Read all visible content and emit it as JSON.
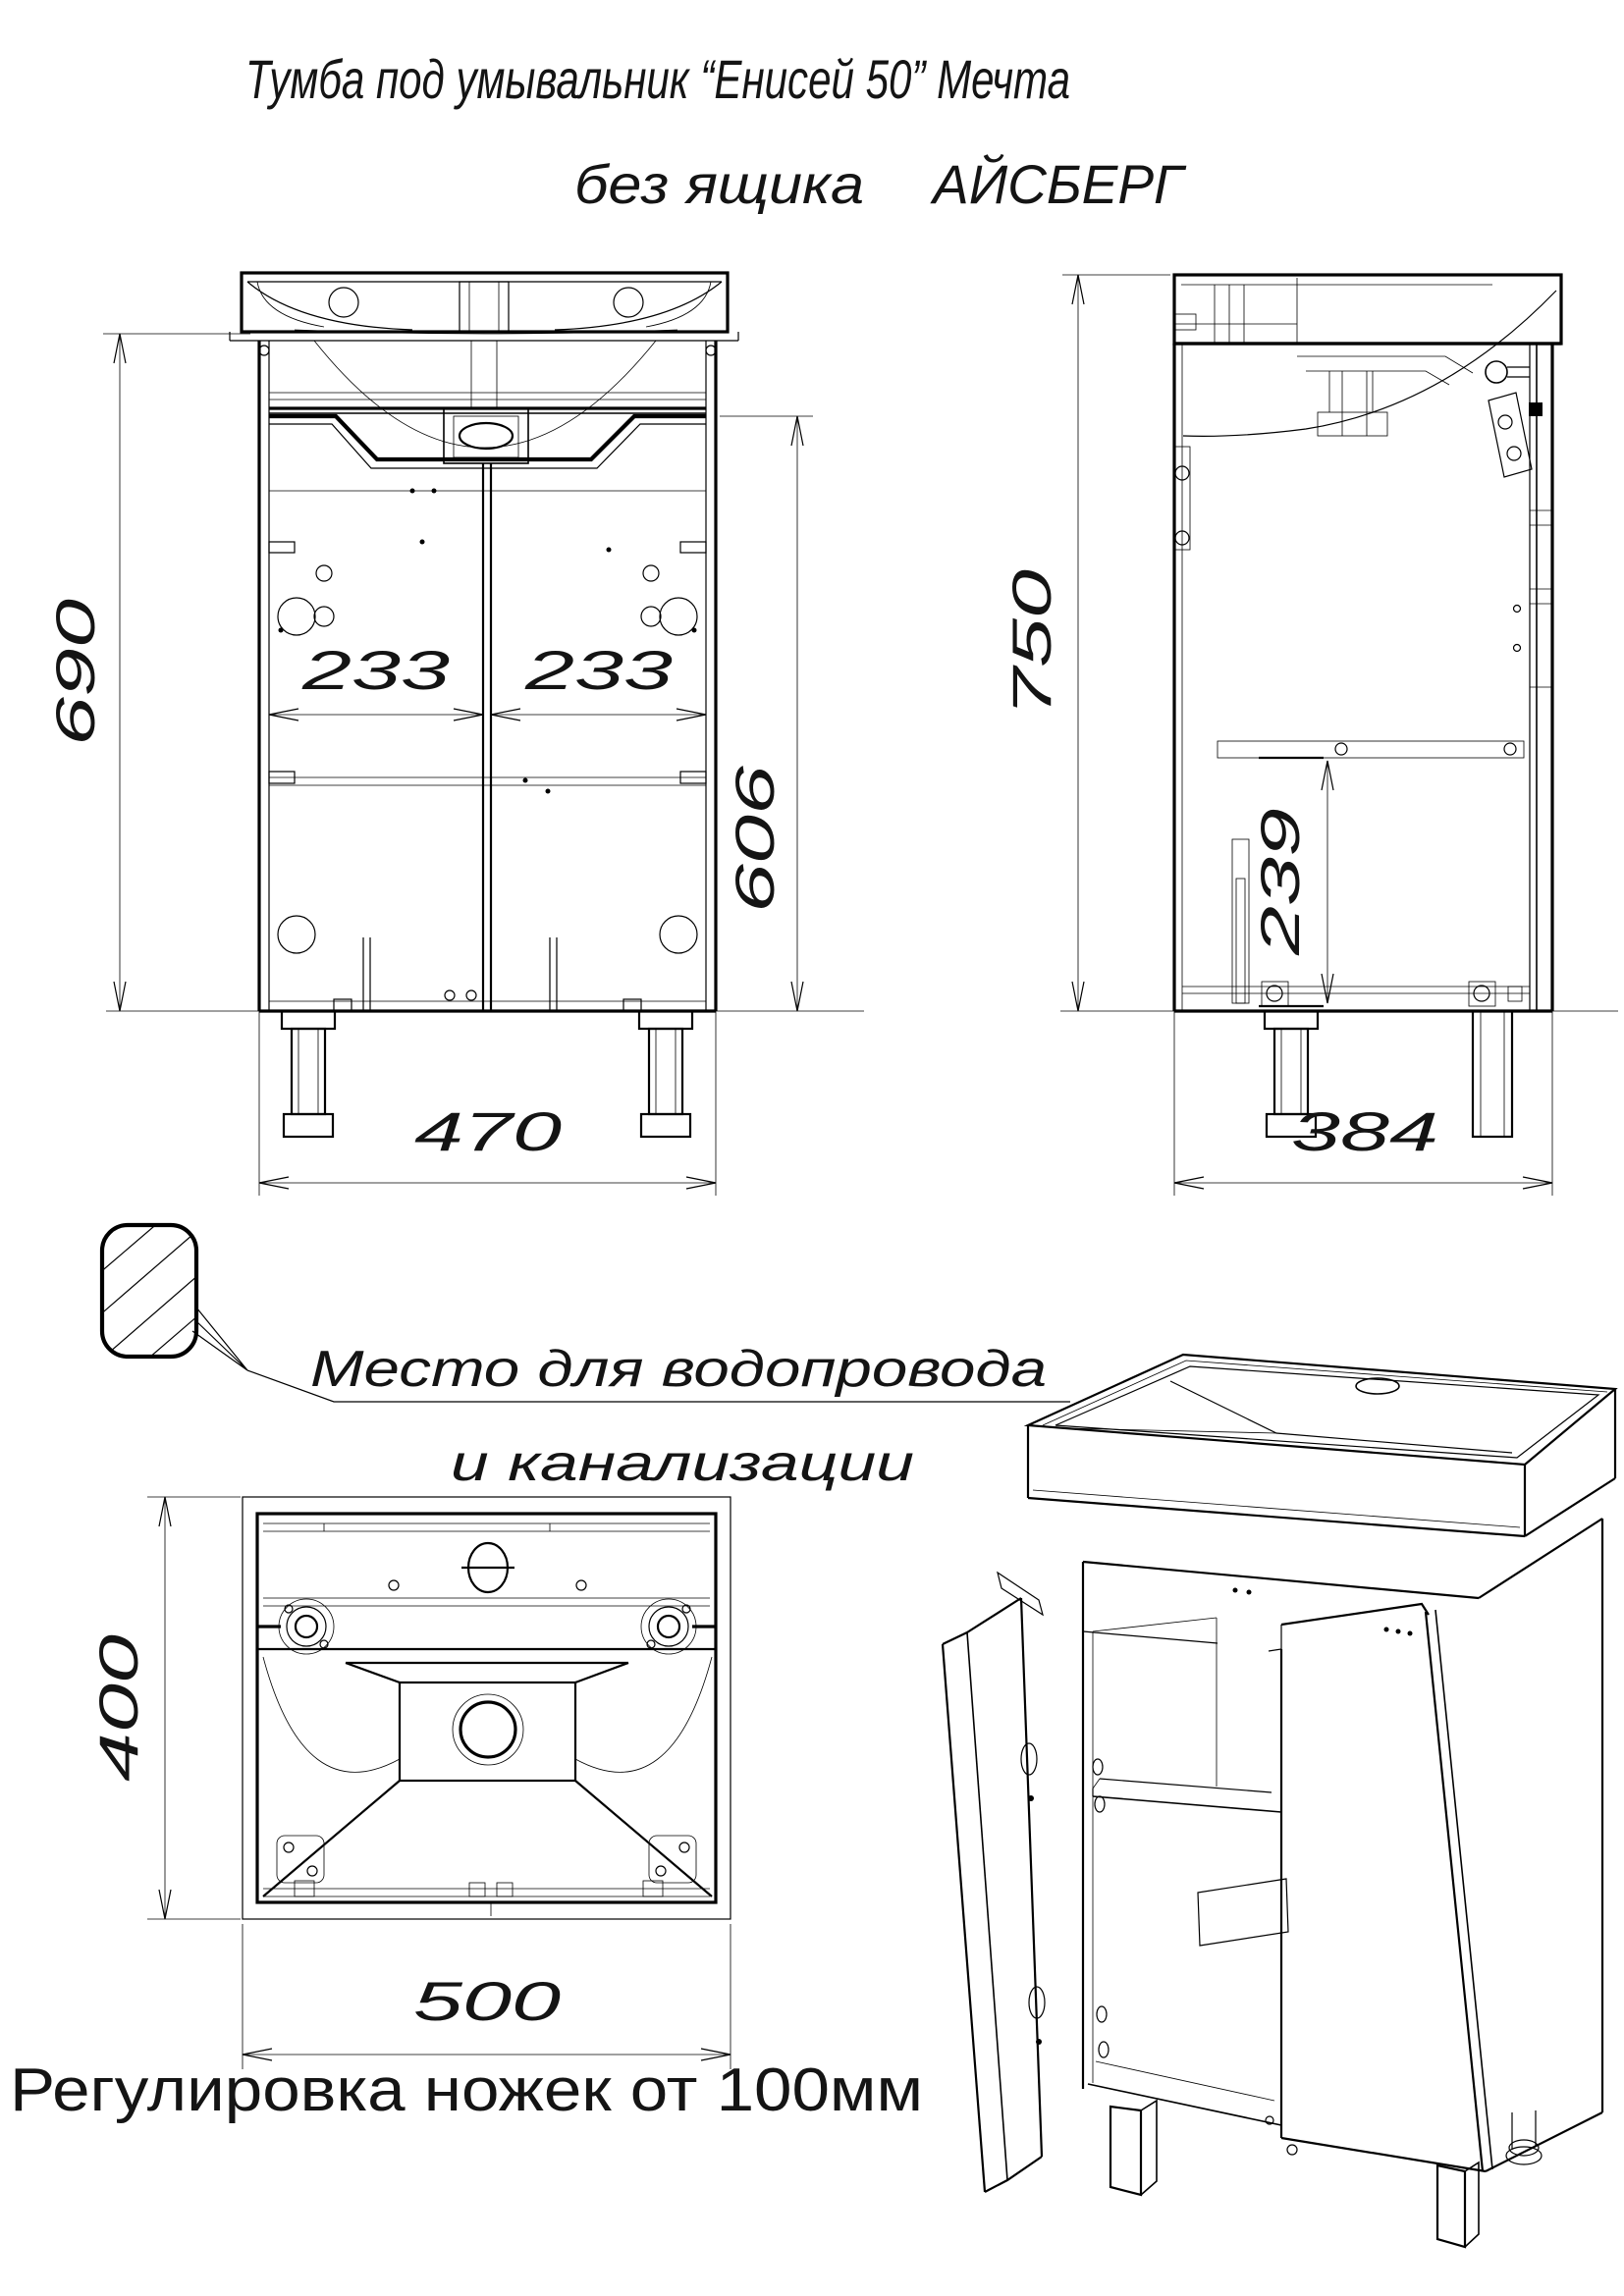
{
  "title": {
    "line1": "Тумба под умывальник “Енисей 50” Мечта",
    "line2_left": "без ящика",
    "line2_right": "АЙСБЕРГ"
  },
  "dims": {
    "front_height_to_top": "690",
    "front_left_door_width": "233",
    "front_right_door_width": "233",
    "front_door_height": "606",
    "front_cabinet_width": "470",
    "side_total_height": "750",
    "side_shelf_height": "239",
    "side_depth": "384",
    "top_depth": "400",
    "top_width": "500"
  },
  "notes": {
    "plumbing_line1": "Место для водопровода",
    "plumbing_line2": "и канализации",
    "legs_note": "Регулировка ножек от 100мм"
  },
  "legend": {
    "hatch_icon": "hatched-rounded-square-plumbing-zone"
  },
  "colors": {
    "line": "#000000",
    "background": "#ffffff"
  }
}
